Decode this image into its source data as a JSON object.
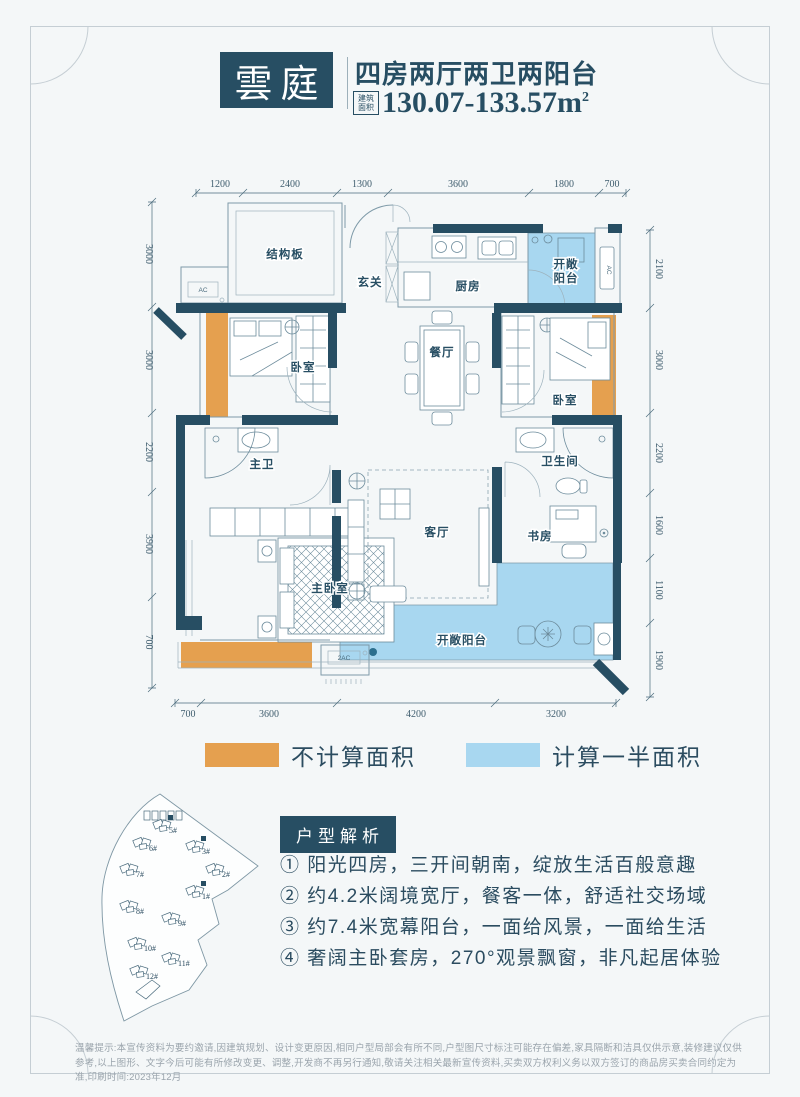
{
  "header": {
    "logo": "雲庭",
    "title": "四房两厅两卫两阳台",
    "area_label_1": "建筑",
    "area_label_2": "面积",
    "area_value": "130.07-133.57m",
    "area_sup": "2"
  },
  "floor_plan": {
    "rooms": {
      "structural": "结构板",
      "foyer": "玄关",
      "kitchen": "厨房",
      "balcony_top_1": "开敞",
      "balcony_top_2": "阳台",
      "bedroom_left": "卧室",
      "dining": "餐厅",
      "bedroom_right": "卧室",
      "master_bath": "主卫",
      "bath": "卫生间",
      "master_bedroom": "主卧室",
      "living": "客厅",
      "study": "书房",
      "balcony_bottom": "开敞阳台",
      "ac": "AC",
      "ac2": "2AC"
    },
    "dims_top": [
      "1200",
      "2400",
      "1300",
      "3600",
      "1800",
      "700"
    ],
    "dims_bottom": [
      "700",
      "3600",
      "4200",
      "3200"
    ],
    "dims_left": [
      "3000",
      "3000",
      "2200",
      "3900",
      "700"
    ],
    "dims_right": [
      "2100",
      "3000",
      "2200",
      "1600",
      "1100",
      "1900"
    ],
    "colors": {
      "wall": "#274e63",
      "not_counted": "#e5a04f",
      "half_counted": "#a8d7f0"
    }
  },
  "legend": [
    {
      "color": "#e5a04f",
      "label": "不计算面积"
    },
    {
      "color": "#a8d7f0",
      "label": "计算一半面积"
    }
  ],
  "analysis": {
    "badge": "户型解析",
    "items": [
      "① 阳光四房，三开间朝南，绽放生活百般意趣",
      "② 约4.2米阔境宽厅，餐客一体，舒适社交场域",
      "③ 约7.4米宽幕阳台，一面给风景，一面给生活",
      "④ 奢阔主卧套房，270°观景飘窗，非凡起居体验"
    ]
  },
  "site_plan": {
    "buildings": [
      {
        "label": "5#",
        "highlight": true
      },
      {
        "label": "6#",
        "highlight": false
      },
      {
        "label": "3#",
        "highlight": true
      },
      {
        "label": "2#",
        "highlight": false
      },
      {
        "label": "7#",
        "highlight": false
      },
      {
        "label": "1#",
        "highlight": true
      },
      {
        "label": "8#",
        "highlight": false
      },
      {
        "label": "9#",
        "highlight": false
      },
      {
        "label": "10#",
        "highlight": false
      },
      {
        "label": "11#",
        "highlight": false
      },
      {
        "label": "12#",
        "highlight": false
      }
    ]
  },
  "disclaimer": {
    "text": "温馨提示:本宣传资料为要约邀请,因建筑规划、设计变更原因,相同户型局部会有所不同,户型图尺寸标注可能存在偏差,家具隔断和洁具仅供示意,装修建议仅供参考,以上图形、文字今后可能有所修改变更、调整,开发商不再另行通知,敬请关注相关最新宣传资料,买卖双方权利义务以双方签订的商品房买卖合同约定为准,印刷时间:2023年12月"
  }
}
